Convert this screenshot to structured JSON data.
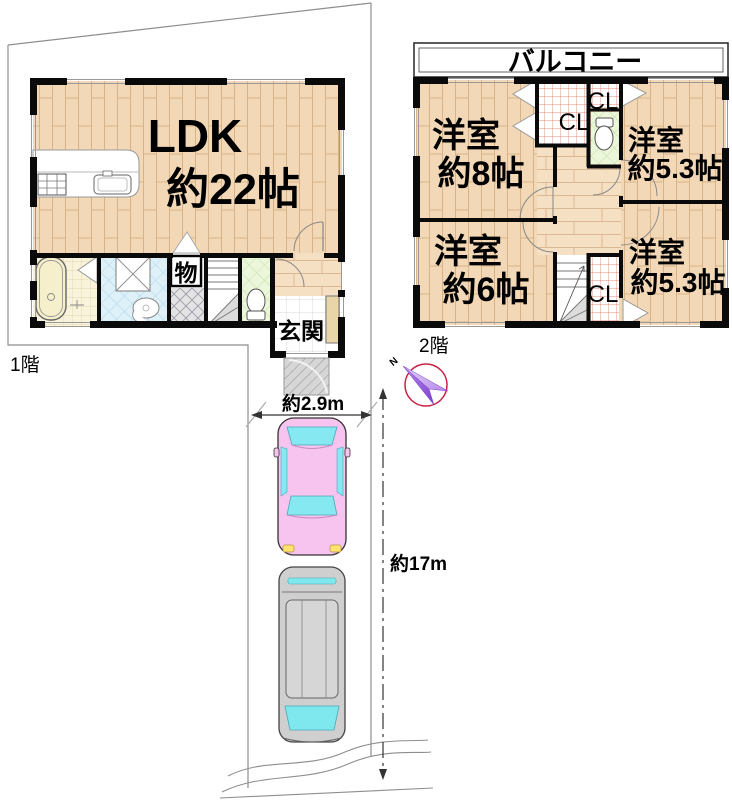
{
  "floor1": {
    "label": "1階",
    "ldk_name": "LDK",
    "ldk_size": "約22帖",
    "storage": "物",
    "entrance": "玄関"
  },
  "floor2": {
    "label": "2階",
    "balcony": "バルコニー",
    "rooms": [
      {
        "name": "洋室",
        "size": "約8帖"
      },
      {
        "name": "洋室",
        "size": "約5.3帖"
      },
      {
        "name": "洋室",
        "size": "約6帖"
      },
      {
        "name": "洋室",
        "size": "約5.3帖"
      }
    ],
    "closet_label": "CL"
  },
  "site": {
    "width_dimension": "約2.9m",
    "depth_dimension": "約17m",
    "compass_north_label": "N"
  },
  "colors": {
    "wall": "#0a0a0a",
    "wood_floor": "#f2d8b6",
    "wood_line": "#d8b387",
    "bath_tile": "#f8f3da",
    "wash_tile": "#def0f8",
    "toilet_tile": "#ebf6da",
    "closet_grid_red": "#dd6655",
    "car_pink": "#f7c4ef",
    "glass_cyan": "#86e9f2",
    "van_gray": "#cfcfcf",
    "compass_red": "#cc2244",
    "compass_purple": "#9a5fd6",
    "boundary_gray": "#8e8e8e"
  }
}
